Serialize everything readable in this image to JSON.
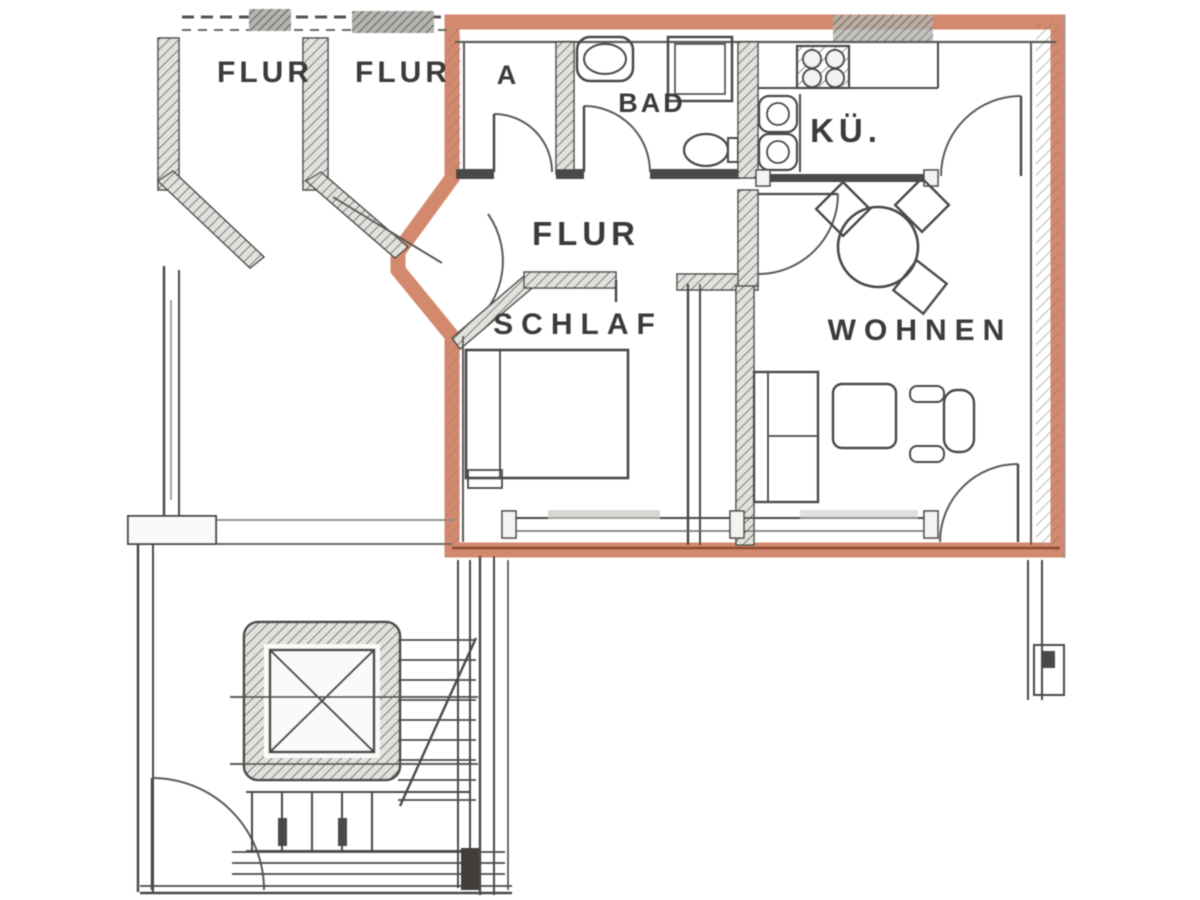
{
  "title": "apartment-floor-plan",
  "labels": {
    "hall_common_left": "FLUR",
    "hall_common_right": "FLUR",
    "storage": "A",
    "bathroom": "BAD",
    "kitchen": "KÜ.",
    "hallway": "FLUR",
    "bedroom": "SCHLAF",
    "living_room": "WOHNEN"
  },
  "colors": {
    "line": "#4a4a48",
    "line_soft": "#8a8a86",
    "highlight": "#cd7a58",
    "highlight_dark": "#9c5638",
    "wall_fill": "#e3e1dd",
    "paper": "#ffffff"
  }
}
